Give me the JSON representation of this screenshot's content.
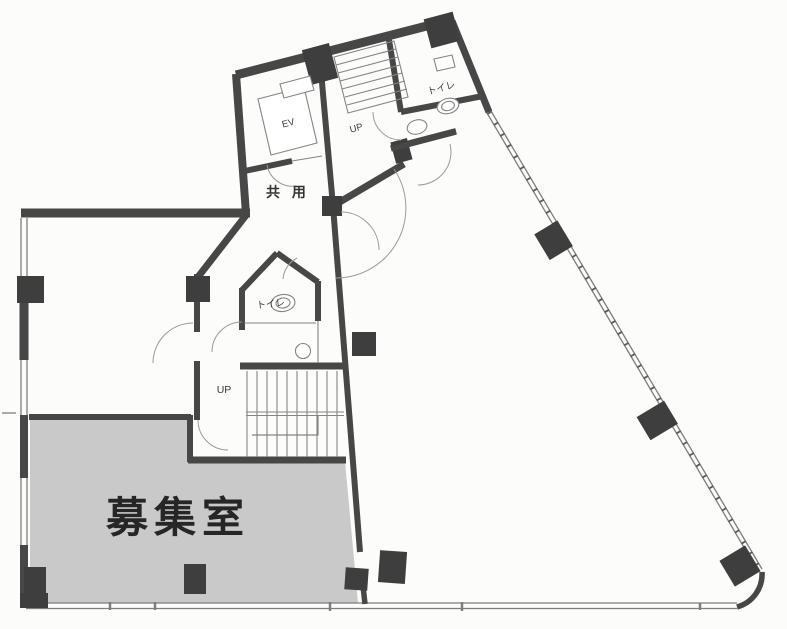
{
  "labels": {
    "vacant_room": "募集室",
    "common_area": "共 用",
    "elevator": "EV",
    "toilet_upper": "トイレ",
    "toilet_middle": "トイレ",
    "up_upper_stairs": "UP",
    "up_main_stairs": "UP"
  },
  "colors": {
    "background": "#fcfcfb",
    "wall": "#474747",
    "column": "#3e3e3e",
    "thin": "#848484",
    "window_line": "#7d7d7d",
    "vacant_fill": "#c9c9c9",
    "label_text": "#262626",
    "small_text": "#3a3a3a"
  }
}
